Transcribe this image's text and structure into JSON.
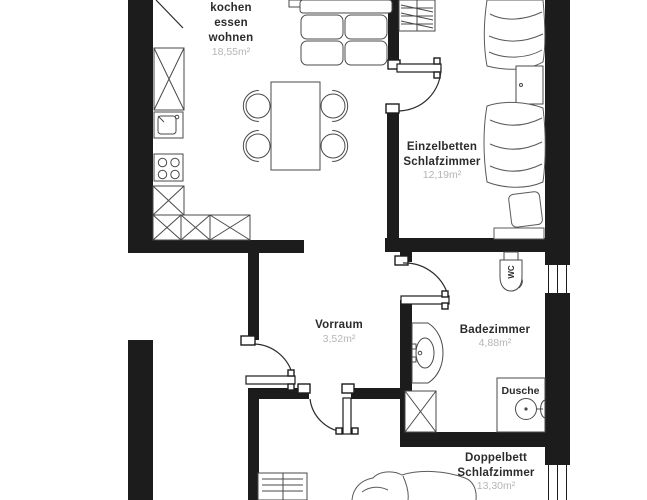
{
  "plan": {
    "background": "#ffffff",
    "wall_color": "#1c1c1c",
    "furniture_line_color": "#4a4a4a",
    "door_line_color": "#2b2b2b",
    "room_label_color": "#2b2b2b",
    "area_label_color": "#b5b5b5"
  },
  "rooms": {
    "living": {
      "lines": [
        "kochen",
        "essen",
        "wohnen"
      ],
      "area": "18,55m²"
    },
    "single_bedroom": {
      "lines": [
        "Einzelbetten",
        "Schlafzimmer"
      ],
      "area": "12,19m²"
    },
    "hallway": {
      "lines": [
        "Vorraum"
      ],
      "area": "3,52m²"
    },
    "bathroom": {
      "lines": [
        "Badezimmer"
      ],
      "area": "4,88m²"
    },
    "double_bedroom": {
      "lines": [
        "Doppelbett",
        "Schlafzimmer"
      ],
      "area": "13,30m²"
    },
    "shower": {
      "label": "Dusche"
    },
    "wc": {
      "label": "WC"
    }
  }
}
